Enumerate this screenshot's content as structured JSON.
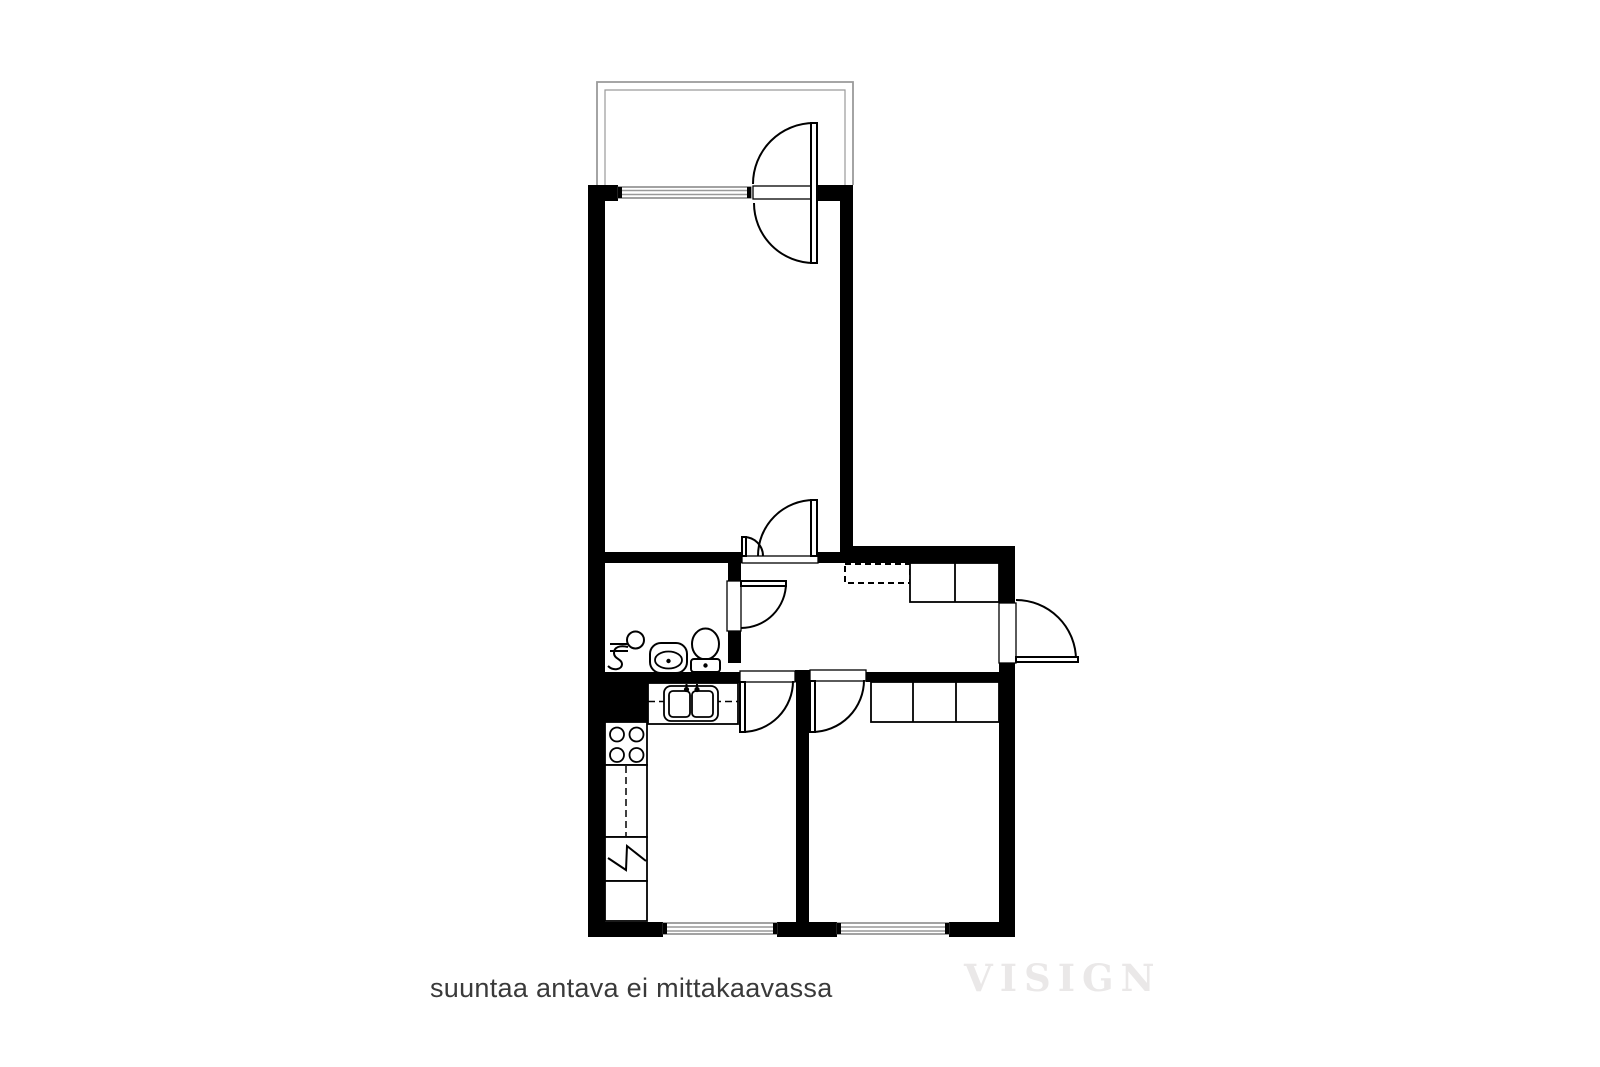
{
  "annotation": {
    "text": "suuntaa antava ei mittakaavassa"
  },
  "watermark": {
    "text": "VISIGN"
  },
  "colors": {
    "background": "#ffffff",
    "walls": "#000000",
    "door_lines": "#000000",
    "balcony_outline": "#9a9a9a",
    "window_glass": "#999999",
    "annotation_text": "#3a3a3a",
    "watermark_text": "#eae8e8"
  },
  "icons": {
    "floor_drain": "circle with S-trap symbol",
    "washbasin": "rounded basin with center dot",
    "toilet": "bowl ellipse with cistern and dot",
    "kitchen_sink": "double basin with faucet dots",
    "stove": "square with four burner circles",
    "fridge_reservation": "cabinet cell with zigzag",
    "appliance_reservation": "cabinet cell with dashed line",
    "wardrobe": "outlined cells along wall",
    "overhead_cabinet": "dashed rectangle"
  }
}
